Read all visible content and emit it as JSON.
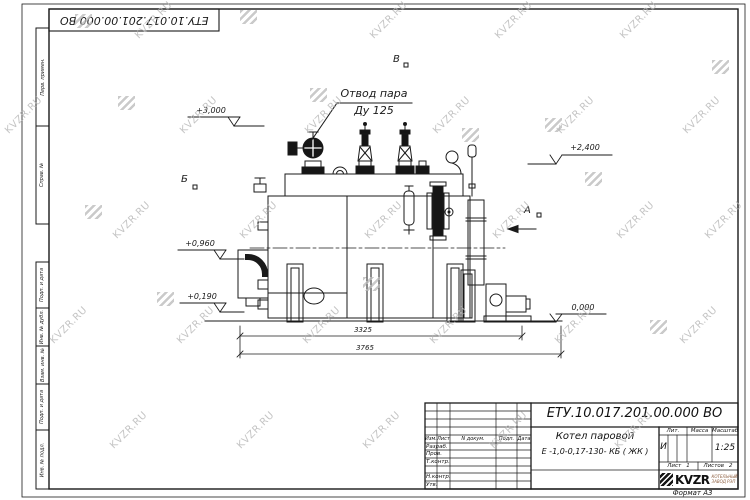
{
  "watermark": {
    "text": "KVZR.RU"
  },
  "corner_stamp": {
    "designation": "ЕТУ.10.017.201.00.000  ВО"
  },
  "margin_labels": [
    "Перв. примен.",
    "Справ. №",
    "Подп. и дата",
    "Инв. № дубл.",
    "Взам. инв. №",
    "Подп. и дата",
    "Инв. № подл."
  ],
  "annotations": {
    "steam_outlet": {
      "line1": "Отвод пара",
      "line2": "Ду 125"
    },
    "elevations": {
      "top_left": "+3,000",
      "top_right": "+2,400",
      "mid_left": "+0,960",
      "low_left": "+0,190",
      "ground": "0,000"
    },
    "views": {
      "a": "А",
      "b": "Б",
      "v": "В"
    },
    "dimensions": {
      "boiler_length": "3325",
      "overall_length": "3765"
    }
  },
  "title_block": {
    "designation": "ЕТУ.10.017.201.00.000  ВО",
    "product_name": {
      "line1": "Котел паровой",
      "line2": "Е -1,0-0,17-130- КБ ( ЖК )"
    },
    "columns": [
      "Изм.",
      "Лист",
      "N докум.",
      "Подп.",
      "Дата"
    ],
    "rows": [
      "Разраб.",
      "Пров.",
      "Т.контр.",
      "Н.контр.",
      "Утв."
    ],
    "lit_label": "Лит.",
    "mass_label": "Масса",
    "scale_label": "Масштаб",
    "lit_value": "И",
    "scale_value": "1:25",
    "sheet_label": "Лист",
    "sheet_value": "1",
    "sheets_label": "Листов",
    "sheets_value": "2",
    "company_name": "KVZR",
    "company_tagline_line1": "КОТЕЛЬНЫЙ",
    "company_tagline_line2": "ЗАВОД РЭП"
  },
  "format_note": "Формат А3"
}
